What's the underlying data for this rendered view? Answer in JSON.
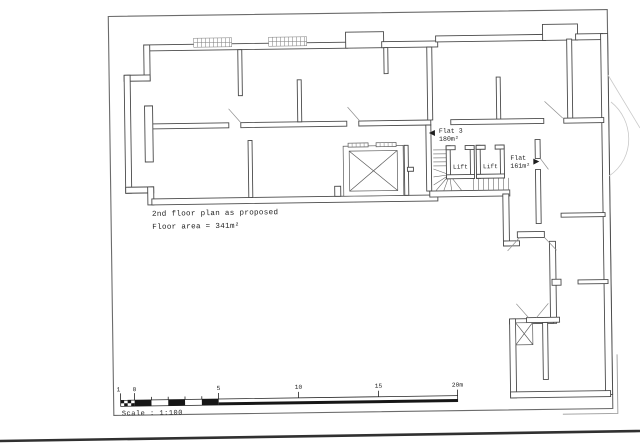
{
  "sheet": {
    "title_line1": "2nd floor plan as proposed",
    "title_line2": "Floor area = 341m²",
    "labels": {
      "flat3_name": "Flat 3",
      "flat3_area": "180m²",
      "lift1": "Lift",
      "lift2": "Lift",
      "flat_right_name": "Flat",
      "flat_right_area": "161m²"
    },
    "scalebar": {
      "ticks": [
        "1",
        "0",
        "5",
        "10",
        "15",
        "20m"
      ],
      "caption": "Scale : 1:100"
    },
    "colors": {
      "ink": "#4a4a4a",
      "paper": "#ffffff"
    }
  }
}
